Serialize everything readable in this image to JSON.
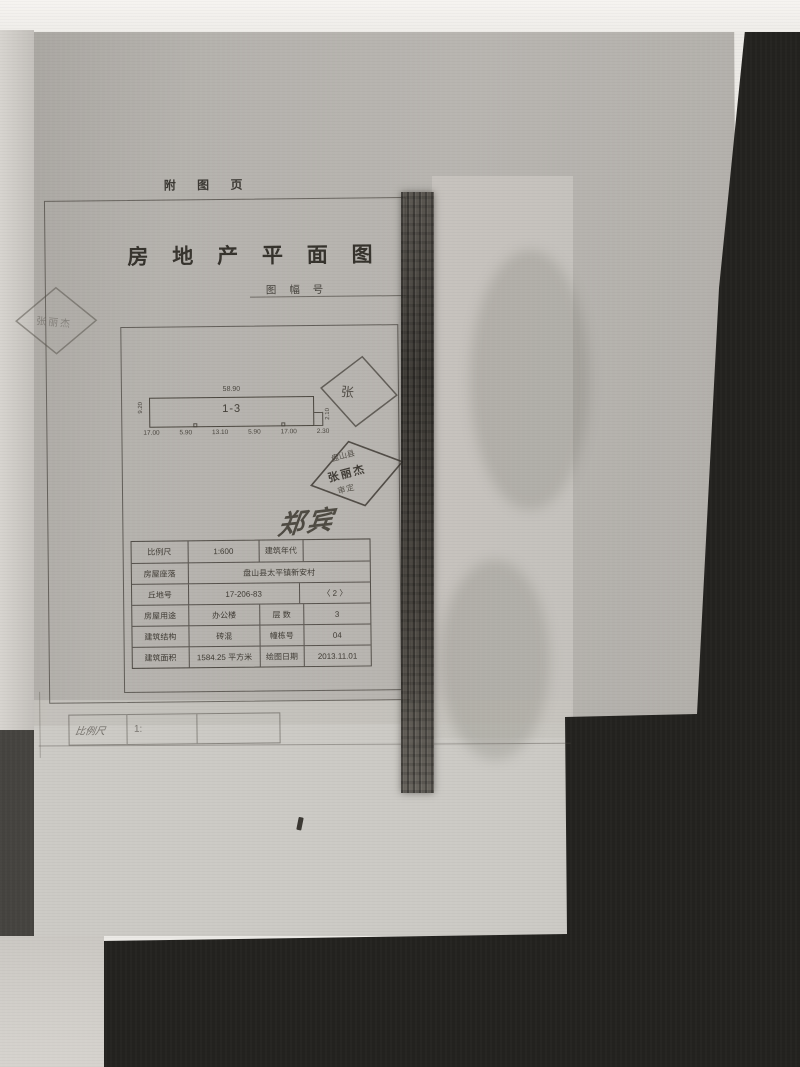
{
  "page": {
    "corner_label": "附 图 页",
    "title": "房 地 产 平 面 图",
    "sheet_no_label": "图 幅 号"
  },
  "floor_plan": {
    "unit_label": "1-3",
    "top_dim": "58.90",
    "bottom_dims": [
      "17.00",
      "5.90",
      "13.10",
      "5.90",
      "17.00",
      "2.30"
    ],
    "left_dim": "9.20",
    "right_dim": "2.10"
  },
  "stamps": {
    "left_faint": "张丽杰",
    "upper": "张",
    "lower_lines": [
      "盘山县",
      "张丽杰",
      "审定"
    ]
  },
  "signature": "郑宾",
  "info_table": {
    "rows": [
      {
        "c0": "比例尺",
        "c1": "1:600",
        "c2": "建筑年代",
        "c3": ""
      },
      {
        "c0": "房屋座落",
        "c1": "盘山县太平镇新安村"
      },
      {
        "c0": "丘地号",
        "c1": "17-206-83",
        "c3": "〈 2 〉"
      },
      {
        "c0": "房屋用途",
        "c1": "办公楼",
        "c2": "层  数",
        "c3": "3"
      },
      {
        "c0": "建筑结构",
        "c1": "砖混",
        "c2": "幢栋号",
        "c3": "04"
      },
      {
        "c0": "建筑面积",
        "c1": "1584.25  平方米",
        "c2": "绘图日期",
        "c3": "2013.11.01"
      }
    ]
  },
  "underlay_sheet": {
    "scale_label": "比例尺",
    "scale_value": "1:"
  },
  "colors": {
    "toner": "#403c35",
    "sheet": "#b4b1ad",
    "underlay": "#c7c4be",
    "dark": "#23221f"
  }
}
